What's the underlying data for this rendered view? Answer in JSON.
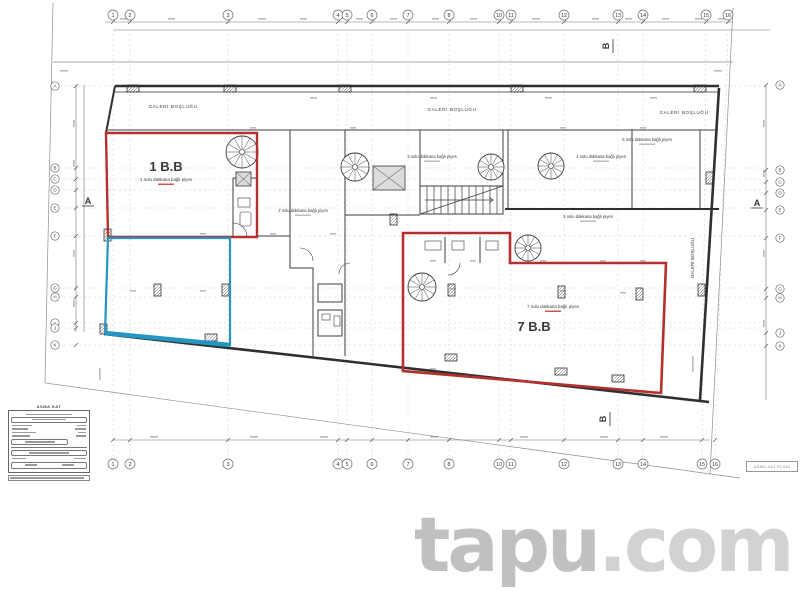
{
  "watermark": {
    "brand": "tapu",
    "tld": ".com"
  },
  "title_block": {
    "header": "ASMA KAT"
  },
  "corner_tag": {
    "text": "ASMA KAT PLANI"
  },
  "section_markers": {
    "left": "A",
    "right": "A",
    "top": "B",
    "bottom": "B"
  },
  "grid": {
    "columns": [
      {
        "n": "1",
        "x": 113
      },
      {
        "n": "2",
        "x": 130
      },
      {
        "n": "3",
        "x": 228
      },
      {
        "n": "4",
        "x": 338
      },
      {
        "n": "5",
        "x": 347
      },
      {
        "n": "6",
        "x": 372
      },
      {
        "n": "7",
        "x": 408
      },
      {
        "n": "8",
        "x": 449
      },
      {
        "n": "10",
        "x": 499
      },
      {
        "n": "11",
        "x": 511
      },
      {
        "n": "12",
        "x": 564
      },
      {
        "n": "13",
        "x": 618
      },
      {
        "n": "14",
        "x": 643
      },
      {
        "n": "15",
        "x": 706,
        "xb": 702
      },
      {
        "n": "16",
        "x": 728,
        "xb": 715
      }
    ],
    "left_rows": [
      {
        "l": "A",
        "y": 86
      },
      {
        "l": "B",
        "y": 168
      },
      {
        "l": "C",
        "y": 179
      },
      {
        "l": "D",
        "y": 190
      },
      {
        "l": "E",
        "y": 208
      },
      {
        "l": "F",
        "y": 236
      },
      {
        "l": "G",
        "y": 288
      },
      {
        "l": "H",
        "y": 297
      },
      {
        "l": "I",
        "y": 323
      },
      {
        "l": "J",
        "y": 328
      },
      {
        "l": "K",
        "y": 345
      }
    ],
    "right_rows": [
      {
        "l": "A",
        "y": 85
      },
      {
        "l": "B",
        "y": 170
      },
      {
        "l": "C",
        "y": 182
      },
      {
        "l": "D",
        "y": 193
      },
      {
        "l": "E",
        "y": 210
      },
      {
        "l": "F",
        "y": 238
      },
      {
        "l": "G",
        "y": 289
      },
      {
        "l": "H",
        "y": 298
      },
      {
        "l": "J",
        "y": 333
      },
      {
        "l": "K",
        "y": 346
      }
    ]
  },
  "labels": {
    "gallery": [
      {
        "text": "GALERİ BOŞLUĞU",
        "x": 173,
        "y": 108
      },
      {
        "text": "GALERİ BOŞLUĞU",
        "x": 452,
        "y": 111
      },
      {
        "text": "GALERİ BOŞLUĞU",
        "x": 684,
        "y": 114
      }
    ],
    "gallery_vertical": {
      "text": "GALERİ BOŞLUĞU",
      "x": 694,
      "y": 258
    },
    "rooms": [
      {
        "label": "2 nolu dükkana bağlı piyes",
        "x": 303,
        "y": 212
      },
      {
        "label": "3 nolu dükkana bağlı piyes",
        "x": 432,
        "y": 158
      },
      {
        "label": "4 nolu dükkana bağlı piyes",
        "x": 601,
        "y": 158
      },
      {
        "label": "5 nolu dükkana bağlı piyes",
        "x": 588,
        "y": 218
      },
      {
        "label": "6 nolu dükkana bağlı piyes",
        "x": 647,
        "y": 141
      }
    ]
  },
  "units": [
    {
      "title": "1 B.B",
      "subtitle": "1 nolu dükkana bağlı piyes",
      "tx": 166,
      "ty": 171,
      "sx": 166,
      "sy": 181
    },
    {
      "title": "7 B.B",
      "subtitle": "7 nolu dükkana bağlı piyes",
      "tx": 534,
      "ty": 331,
      "sx": 553,
      "sy": 308
    }
  ],
  "colors": {
    "red": "#b5302c",
    "blue": "#2396c2",
    "ink": "#3a3a3a",
    "red_text": "#c32a28",
    "watermark": "#c6c6c6",
    "centerline": "#c9c9c9"
  }
}
